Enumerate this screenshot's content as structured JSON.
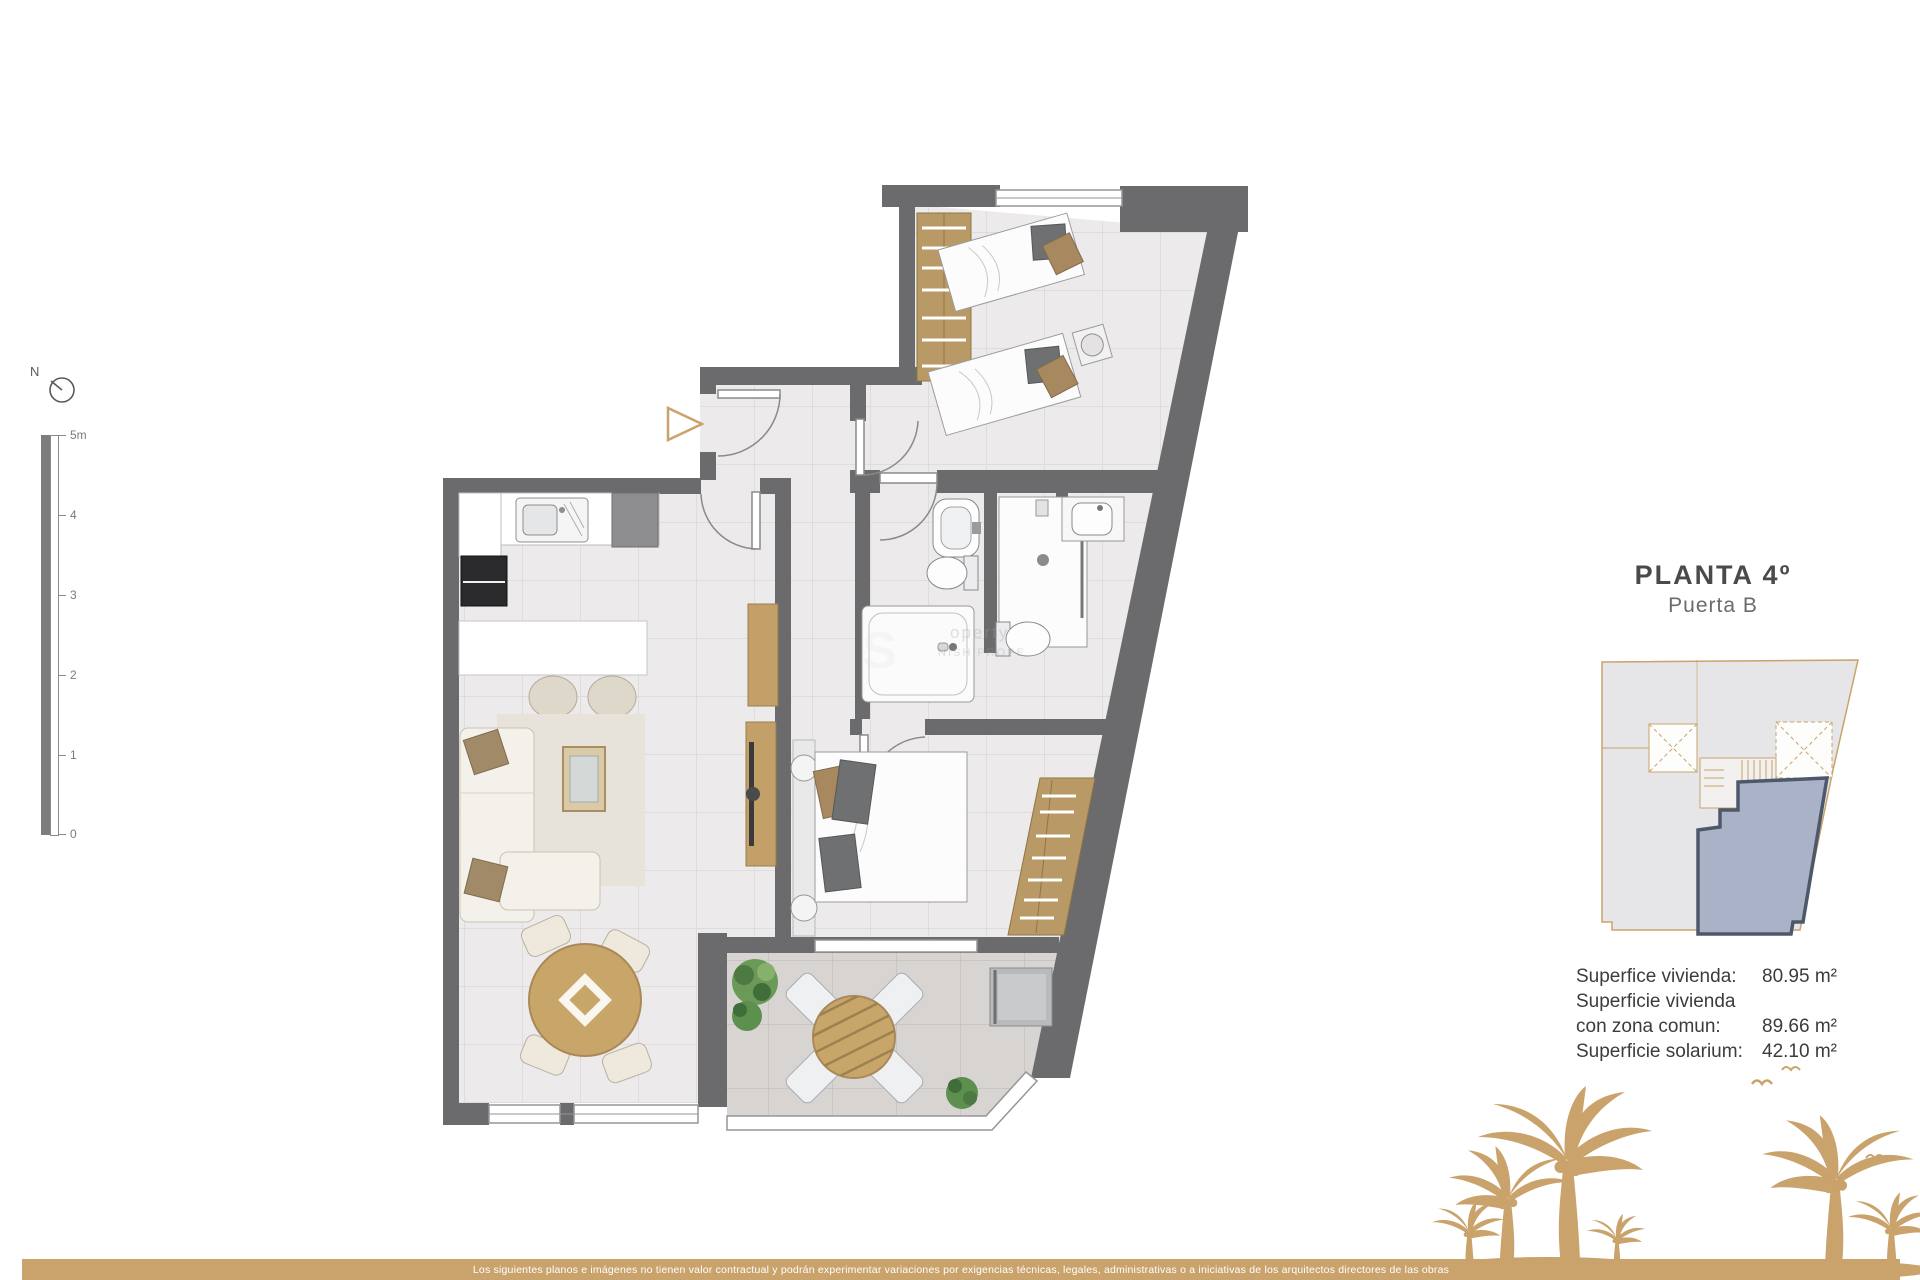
{
  "header": {
    "title": "PLANTA 4º",
    "subtitle": "Puerta B"
  },
  "areas": {
    "rows": [
      {
        "label": "Superfice vivienda:",
        "value": "80.95 m²"
      },
      {
        "label": "Superficie vivienda con zona comun:",
        "value": "89.66 m²"
      },
      {
        "label": "Superficie solarium:",
        "value": "42.10 m²"
      }
    ]
  },
  "scale_bar": {
    "ticks": [
      "5m",
      "4",
      "3",
      "2",
      "1",
      "0"
    ]
  },
  "compass": {
    "label": "N"
  },
  "watermark": {
    "line1": "operty",
    "line2": "NISH PROPE"
  },
  "footer": {
    "disclaimer": "Los siguientes planos e imágenes no tienen valor contractual y podrán experimentar variaciones por exigencias técnicas, legales, administrativas o a iniciativas de los arquitectos directores de las obras"
  },
  "colors": {
    "accent_tan": "#c9a36b",
    "wall_gray": "#6b6b6d",
    "wood": "#c2a068",
    "unit_highlight": "#aab2c8",
    "terrace_tile": "#d7d4d1"
  }
}
